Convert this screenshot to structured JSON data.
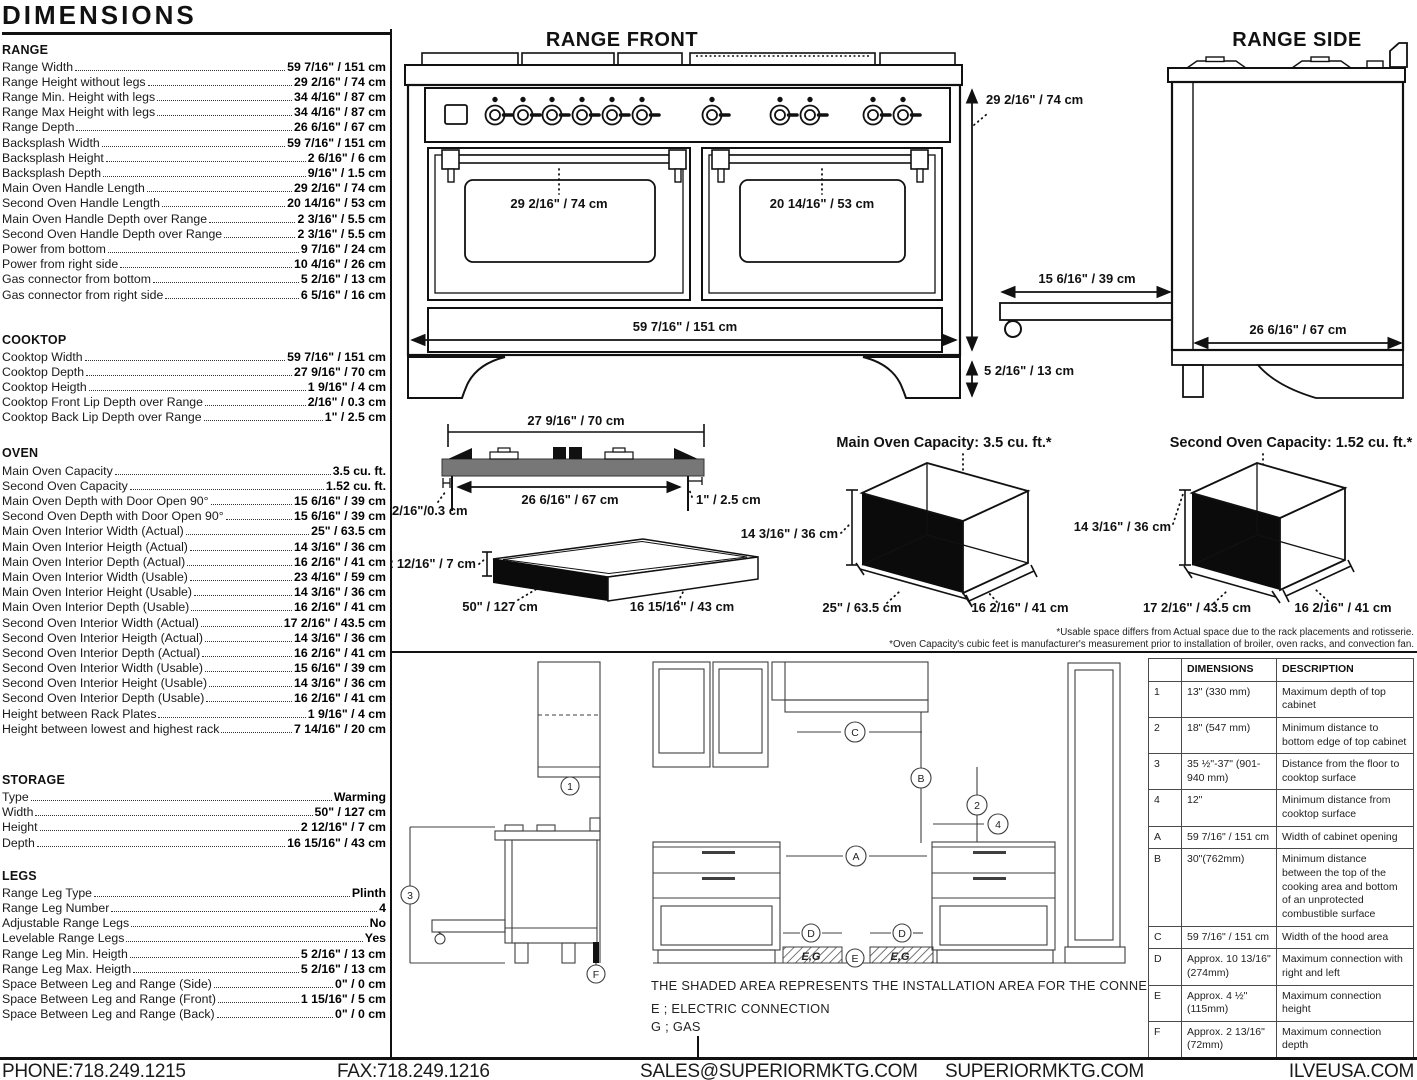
{
  "title": "DIMENSIONS",
  "specs": {
    "range": {
      "heading": "RANGE",
      "rows": [
        {
          "l": "Range Width",
          "v": "59 7/16\" / 151 cm"
        },
        {
          "l": "Range Height without legs",
          "v": "29 2/16\" / 74 cm"
        },
        {
          "l": "Range Min. Height with legs",
          "v": "34 4/16\" / 87 cm"
        },
        {
          "l": "Range Max Height with legs",
          "v": "34 4/16\" / 87 cm"
        },
        {
          "l": "Range Depth",
          "v": "26 6/16\" / 67 cm"
        },
        {
          "l": "Backsplash Width",
          "v": "59 7/16\" / 151 cm"
        },
        {
          "l": "Backsplash Height",
          "v": "2 6/16\" / 6 cm"
        },
        {
          "l": "Backsplash Depth",
          "v": "9/16\" / 1.5 cm"
        },
        {
          "l": "Main Oven Handle Length",
          "v": "29 2/16\" / 74 cm"
        },
        {
          "l": "Second Oven Handle Length",
          "v": "20 14/16\" / 53 cm"
        },
        {
          "l": "Main Oven Handle Depth over Range",
          "v": "2 3/16\" / 5.5 cm"
        },
        {
          "l": "Second Oven Handle Depth over Range",
          "v": "2 3/16\" / 5.5 cm"
        },
        {
          "l": "Power from bottom",
          "v": "9 7/16\" / 24 cm"
        },
        {
          "l": "Power from right side",
          "v": "10 4/16\" / 26 cm"
        },
        {
          "l": "Gas connector from bottom",
          "v": "5 2/16\" / 13 cm"
        },
        {
          "l": "Gas connector from right side",
          "v": "6 5/16\" / 16 cm"
        }
      ]
    },
    "cooktop": {
      "heading": "COOKTOP",
      "rows": [
        {
          "l": "Cooktop Width",
          "v": "59 7/16\" / 151 cm"
        },
        {
          "l": "Cooktop Depth",
          "v": "27 9/16\" / 70 cm"
        },
        {
          "l": "Cooktop Heigth",
          "v": "1 9/16\" / 4 cm"
        },
        {
          "l": "Cooktop Front Lip Depth over Range",
          "v": "2/16\" / 0.3 cm"
        },
        {
          "l": "Cooktop Back Lip Depth over Range",
          "v": "1\" / 2.5 cm"
        }
      ]
    },
    "oven": {
      "heading": "OVEN",
      "rows": [
        {
          "l": "Main Oven Capacity",
          "v": "3.5 cu. ft."
        },
        {
          "l": "Second Oven Capacity",
          "v": "1.52 cu. ft."
        },
        {
          "l": "Main Oven Depth with Door Open 90°",
          "v": "15 6/16\" / 39 cm"
        },
        {
          "l": "Second Oven Depth with Door Open 90°",
          "v": "15 6/16\" / 39 cm"
        },
        {
          "l": "Main Oven Interior Width (Actual)",
          "v": "25\" / 63.5 cm"
        },
        {
          "l": "Main Oven Interior Heigth (Actual)",
          "v": "14 3/16\" / 36 cm"
        },
        {
          "l": "Main Oven Interior Depth (Actual)",
          "v": "16 2/16\" / 41 cm"
        },
        {
          "l": "Main Oven Interior Width (Usable)",
          "v": "23 4/16\" / 59 cm"
        },
        {
          "l": "Main Oven Interior Height (Usable)",
          "v": "14 3/16\" / 36 cm"
        },
        {
          "l": "Main Oven Interior Depth (Usable)",
          "v": "16 2/16\" / 41 cm"
        },
        {
          "l": "Second Oven Interior Width (Actual)",
          "v": "17 2/16\" / 43.5 cm"
        },
        {
          "l": "Second Oven Interior Heigth (Actual)",
          "v": "14 3/16\" / 36 cm"
        },
        {
          "l": "Second Oven Interior Depth (Actual)",
          "v": "16 2/16\" / 41 cm"
        },
        {
          "l": "Second Oven Interior Width (Usable)",
          "v": "15 6/16\" / 39 cm"
        },
        {
          "l": "Second Oven Interior Height (Usable)",
          "v": "14 3/16\" / 36 cm"
        },
        {
          "l": "Second Oven Interior Depth (Usable)",
          "v": "16 2/16\" / 41 cm"
        },
        {
          "l": "Height between Rack Plates",
          "v": "1 9/16\" / 4 cm"
        },
        {
          "l": "Height between lowest and highest rack",
          "v": "7 14/16\" / 20 cm"
        }
      ]
    },
    "storage": {
      "heading": "STORAGE",
      "rows": [
        {
          "l": "Type",
          "v": "Warming"
        },
        {
          "l": "Width",
          "v": "50\" / 127 cm"
        },
        {
          "l": "Height",
          "v": "2 12/16\" / 7 cm"
        },
        {
          "l": "Depth",
          "v": "16 15/16\" / 43 cm"
        }
      ]
    },
    "legs": {
      "heading": "LEGS",
      "rows": [
        {
          "l": "Range Leg Type",
          "v": "Plinth"
        },
        {
          "l": "Range Leg Number",
          "v": "4"
        },
        {
          "l": "Adjustable Range Legs",
          "v": "No"
        },
        {
          "l": "Levelable Range Legs",
          "v": "Yes"
        },
        {
          "l": "Range Leg Min. Heigth",
          "v": "5 2/16\" / 13 cm"
        },
        {
          "l": "Range Leg Max. Heigth",
          "v": "5 2/16\" / 13 cm"
        },
        {
          "l": "Space Between Leg and Range (Side)",
          "v": "0\" / 0 cm"
        },
        {
          "l": "Space Between Leg and Range (Front)",
          "v": "1 15/16\" / 5 cm"
        },
        {
          "l": "Space Between Leg and Range (Back)",
          "v": "0\" / 0 cm"
        }
      ]
    }
  },
  "front": {
    "title": "RANGE FRONT",
    "height": "29 2/16\" / 74 cm",
    "main_door": "29 2/16\" / 74 cm",
    "second_door": "20 14/16\" / 53 cm",
    "width": "59 7/16\" / 151 cm",
    "legs": "5 2/16\" / 13 cm"
  },
  "side": {
    "title": "RANGE SIDE",
    "shelf": "15 6/16\" / 39 cm",
    "depth": "26 6/16\" / 67 cm"
  },
  "cooktop_profile": {
    "top": "27 9/16\" / 70 cm",
    "bottom": "26 6/16\" / 67 cm",
    "front_lip": "2/16\"/0.3 cm",
    "back_lip": "1\" / 2.5 cm"
  },
  "storage_box": {
    "height": "2 12/16\" / 7 cm",
    "width": "50\" / 127 cm",
    "depth": "16 15/16\" / 43 cm"
  },
  "oven_main": {
    "title": "Main Oven Capacity: 3.5 cu. ft.*",
    "height": "14 3/16\" / 36 cm",
    "width": "25\" / 63.5 cm",
    "depth": "16 2/16\" / 41 cm"
  },
  "oven_second": {
    "title": "Second Oven Capacity: 1.52 cu. ft.*",
    "height": "14 3/16\" / 36 cm",
    "width": "17 2/16\" / 43.5 cm",
    "depth": "16 2/16\" / 41 cm"
  },
  "footnotes": [
    "*Usable space differs from Actual space due to the rack placements and rotisserie.",
    "*Oven Capacity's cubic feet is manufacturer's measurement prior to installation of broiler, oven racks, and convection fan."
  ],
  "install": {
    "note": "THE SHADED AREA REPRESENTS THE INSTALLATION AREA FOR THE CONNECTIONS;",
    "e": "E ; ELECTRIC CONNECTION",
    "g": "G ; GAS",
    "eg": "E,G",
    "callouts": {
      "c1": "1",
      "c2": "2",
      "c3": "3",
      "c4": "4",
      "cA": "A",
      "cB": "B",
      "cC": "C",
      "cD": "D",
      "cE": "E",
      "cF": "F"
    }
  },
  "table": {
    "headers": [
      "",
      "DIMENSIONS",
      "DESCRIPTION"
    ],
    "rows": [
      {
        "key": "1",
        "dim": "13\" (330 mm)",
        "desc": "Maximum depth of top cabinet"
      },
      {
        "key": "2",
        "dim": "18\" (547 mm)",
        "desc": "Minimum distance to bottom edge of top cabinet"
      },
      {
        "key": "3",
        "dim": "35 ½\"-37\" (901-940 mm)",
        "desc": "Distance from the floor to cooktop surface"
      },
      {
        "key": "4",
        "dim": "12\"",
        "desc": "Minimum distance from cooktop surface"
      },
      {
        "key": "A",
        "dim": "59 7/16\" / 151 cm",
        "desc": "Width of cabinet opening"
      },
      {
        "key": "B",
        "dim": "30\"(762mm)",
        "desc": "Minimum distance between the top of the cooking area and bottom of an unprotected combustible surface"
      },
      {
        "key": "C",
        "dim": "59 7/16\" / 151 cm",
        "desc": "Width of the hood area"
      },
      {
        "key": "D",
        "dim": "Approx. 10 13/16\" (274mm)",
        "desc": "Maximum connection with right and left"
      },
      {
        "key": "E",
        "dim": "Approx. 4 ½\" (115mm)",
        "desc": "Maximum connection height"
      },
      {
        "key": "F",
        "dim": "Approx. 2 13/16\" (72mm)",
        "desc": "Maximum connection depth"
      }
    ]
  },
  "footer": {
    "phone": "PHONE:718.249.1215",
    "fax": "FAX:718.249.1216",
    "email": "SALES@SUPERIORMKTG.COM",
    "site": "SUPERIORMKTG.COM",
    "site2": "ILVEUSA.COM"
  }
}
